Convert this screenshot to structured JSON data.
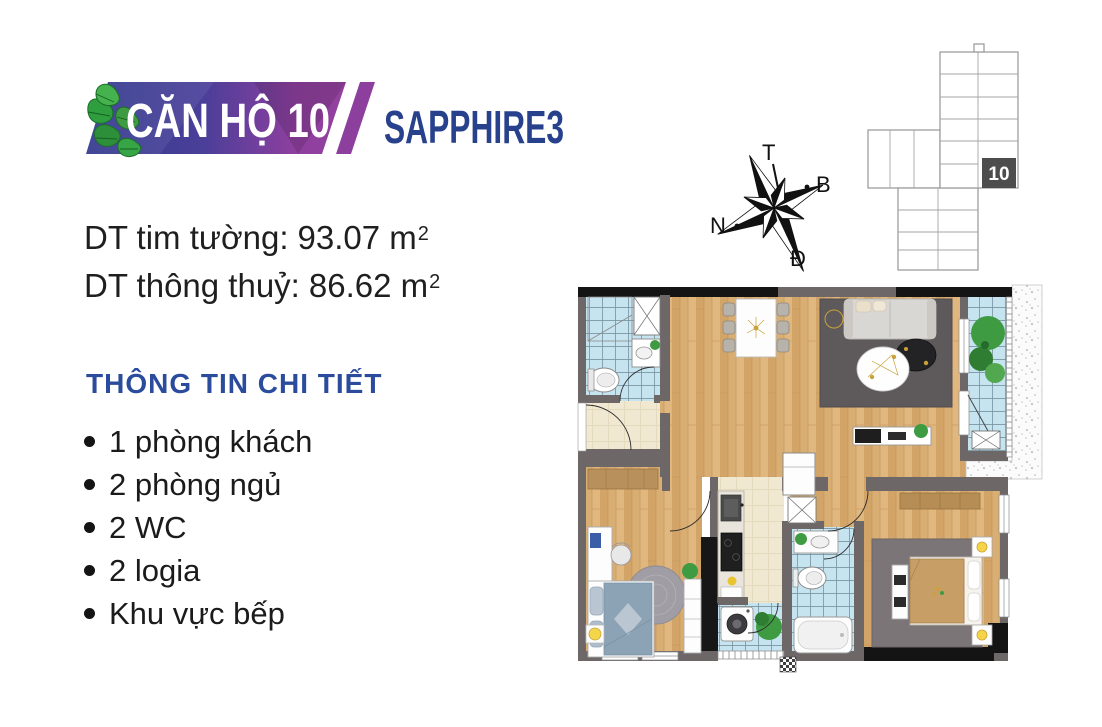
{
  "logo": {
    "unit_label": "CĂN HỘ 10",
    "building_label": "SAPPHIRE3"
  },
  "areas": {
    "gross": {
      "label": "DT tim tường:",
      "value": "93.07 m",
      "sup": "2"
    },
    "net": {
      "label": "DT thông thuỷ:",
      "value": "86.62 m",
      "sup": "2"
    }
  },
  "details": {
    "heading": "THÔNG TIN CHI TIẾT",
    "items": [
      "1 phòng khách",
      "2 phòng ngủ",
      "2 WC",
      "2 logia",
      "Khu vực bếp"
    ]
  },
  "compass": {
    "top": "T",
    "right": "B",
    "left": "N",
    "bottom": "Đ"
  },
  "key_plan": {
    "unit_number": "10"
  },
  "colors": {
    "heading_blue": "#2b4b9c",
    "logo_navy": "#333b8e",
    "logo_purple": "#8d3f9e",
    "logo_leaf_green": "#3f9b42",
    "wall_gray": "#6e6768",
    "wood_floor": "#d9ae73",
    "tile_blue": "#c6e4f0",
    "tile_beige": "#f0e8d1",
    "text_black": "#1b1b1b"
  }
}
